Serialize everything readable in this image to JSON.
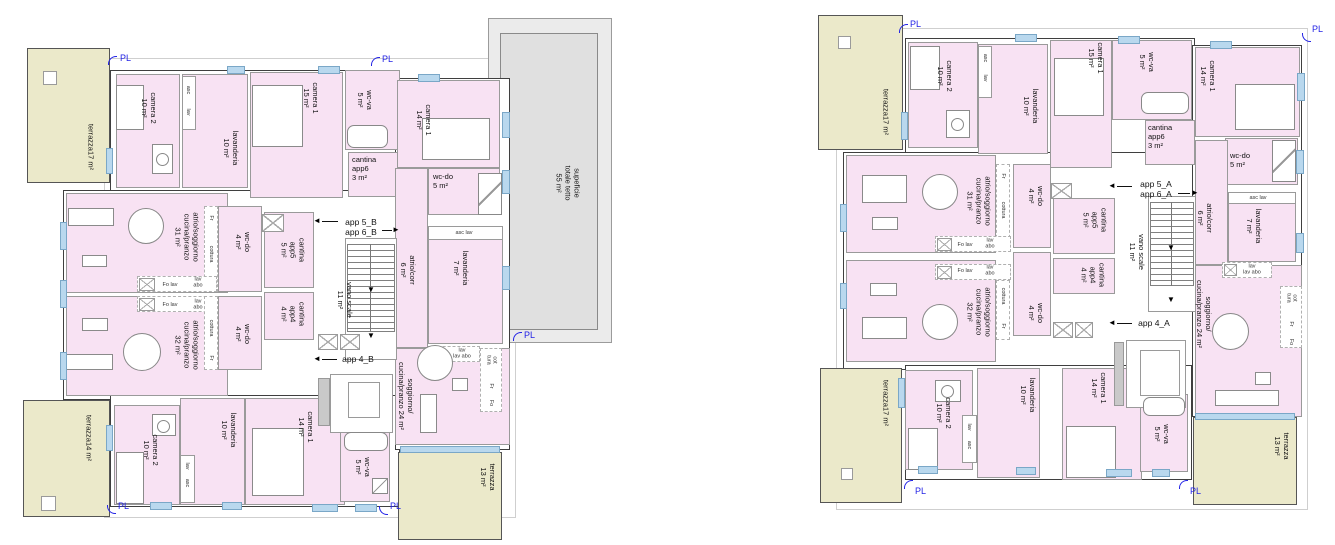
{
  "pl_label": "PL",
  "icons": {
    "arrow_left": "◄",
    "arrow_right": "►",
    "arrow_down": "▼"
  },
  "colors": {
    "room_pink": "#f8e2f3",
    "terrace": "#ebe9ca",
    "window_blue": "#b9d8ee",
    "roof_gray": "#ebebeb",
    "roof_inner_gray": "#e0e0e0",
    "pl_blue": "#2323e6"
  },
  "tiny": {
    "asc": "asc",
    "lav": "lav",
    "fr": "Fr",
    "fo": "Fo",
    "cottura": "cottura",
    "fo_lav": "Fo lav",
    "lav_abo": "lav\nabo",
    "lav_lavabo": "lav\nlav  abo",
    "cot_tura": "cot\ntura",
    "asc_lav": "asc   lav"
  },
  "plan_b": {
    "roof_label": "supeficie\ntotale tetto\n55 m²",
    "terrace_tl": "terrazza17 m²",
    "terrace_bl": "terrazza14 m²",
    "terrace_br": "terrazza\n13 m²",
    "camera2_top": "camera 2\n10 m²",
    "lavanderia_top": "lavanderia\n10 m²",
    "camera1_15": "camera 1\n15 m²",
    "wcva_top": "wc-va\n5 m²",
    "cantina_app6": "cantina\napp6\n3 m²",
    "camera1_14_top": "camera 1\n14 m²",
    "wcdo_5": "wc-do\n5 m²",
    "app_5_6": "app 5_B\napp 6_B",
    "app_4": "app 4_B",
    "atrio_31": "atrio/soggiorno\ncucina/pranzo\n31 m²",
    "atrio_32": "atrio/soggiorno\ncucina/pranzo\n32 m²",
    "wcdo4_top": "wc-do\n4 m²",
    "wcdo4_bot": "wc-do\n4 m²",
    "cantina_app5": "cantina\napp5\n5 m²",
    "cantina_app4": "cantina\napp4\n4 m²",
    "vano_scale": "vano scale\n11 m²",
    "atrio_corr": "atrio/corr\n6 m²",
    "lavanderia_7": "lavanderia\n7 m²",
    "sogg_24": "soggiorno/\ncucina/pranzo 24 m²",
    "camera2_bot": "camera 2\n10 m²",
    "lavanderia_bot": "lavanderia\n10 m²",
    "camera1_14_bot": "camera 1\n14 m²",
    "wcva_bot": "wc-va\n5 m²"
  },
  "plan_a": {
    "terrace_tl": "terrazza17 m²",
    "terrace_bl": "terrazza17 m²",
    "terrace_br": "terrazza\n13 m²",
    "camera2_top": "camera 2\n10 m²",
    "lavanderia_top": "lavanderia\n10 m²",
    "camera1_15": "camera 1\n15 m²",
    "wcva_top": "wc-va\n5 m²",
    "cantina_app6": "cantina\napp6\n3 m²",
    "camera1_14_top": "camera 1\n14 m²",
    "wcdo_5": "wc-do\n5 m²",
    "app_5_6": "app 5_A\napp 6_A",
    "app_4": "app 4_A",
    "atrio_31": "atrio/soggiorno\ncucina/pranzo\n31 m²",
    "atrio_32": "atrio/soggiorno\ncucina/pranzo\n32 m²",
    "wcdo4_top": "wc-do\n4 m²",
    "wcdo4_bot": "wc-do\n4 m²",
    "cantina_app5": "cantina\napp5\n5 m²",
    "cantina_app4": "cantina\napp4\n4 m²",
    "vano_scale": "vano scale\n11 m²",
    "atrio_corr": "atrio/corr\n6 m²",
    "lavanderia_7": "lavanderia\n7 m²",
    "sogg_24": "soggiorno/\ncucina/pranzo 24 m²",
    "camera2_bot": "camera 2\n10 m²",
    "lavanderia_bot": "lavanderia\n10 m²",
    "camera1_14_bot": "camera 1\n14 m²",
    "wcva_bot": "wc-va\n5 m²"
  }
}
